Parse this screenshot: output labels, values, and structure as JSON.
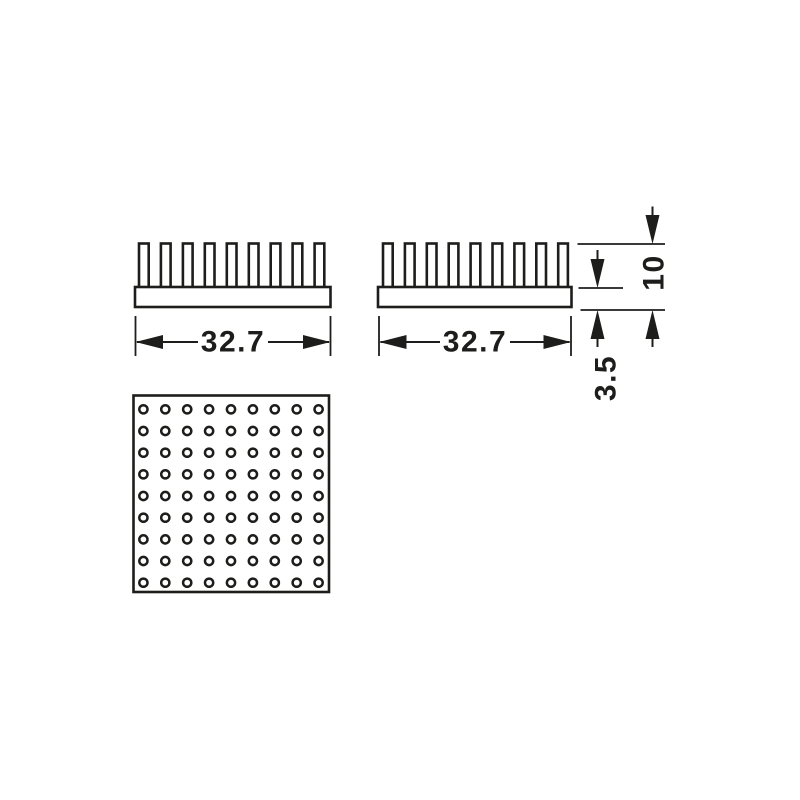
{
  "drawing": {
    "background_color": "#ffffff",
    "line_color": "#1d1d1b",
    "views": {
      "side_left": {
        "fin_count": 9,
        "width_label": "32.7"
      },
      "side_right": {
        "fin_count": 9,
        "width_label": "32.7"
      },
      "top": {
        "hole_rows": 9,
        "hole_columns": 9
      }
    },
    "vertical_dimensions": {
      "overall_height_label": "10",
      "base_thickness_label": "3.5"
    }
  }
}
